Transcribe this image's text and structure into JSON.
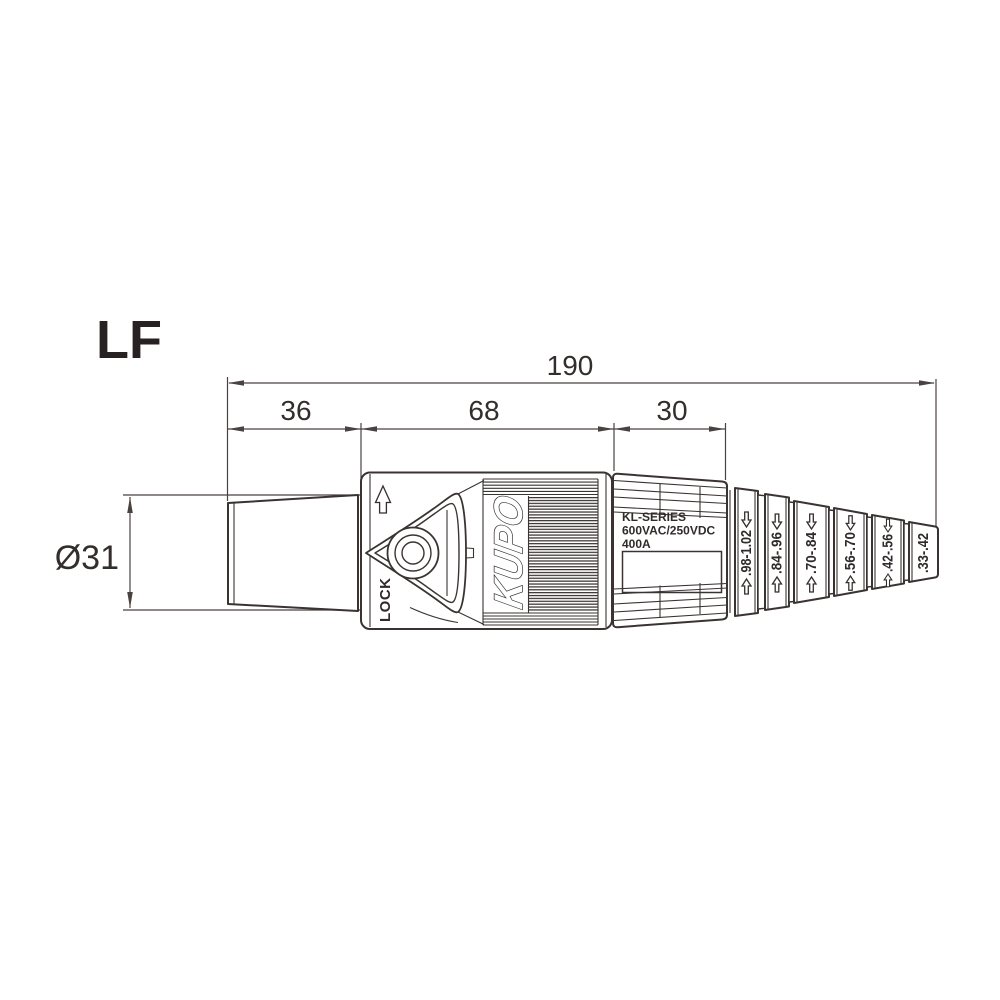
{
  "title": "LF",
  "dimensions": {
    "overall_length": "190",
    "front_length": "36",
    "body_length": "68",
    "rear_length": "30",
    "front_diameter": "Ø31"
  },
  "body": {
    "lock_label": "LOCK",
    "brand_logo": "KUPO"
  },
  "rear_panel": {
    "series": "KL-SERIES",
    "voltage_rating": "600VAC/250VDC",
    "current_rating": "400A"
  },
  "cable_gland": {
    "segments": [
      {
        "range": ".98-1.02"
      },
      {
        "range": ".84-.96"
      },
      {
        "range": ".70-.84"
      },
      {
        "range": ".56-.70"
      },
      {
        "range": ".42-.56"
      },
      {
        "range": ".33-.42"
      }
    ]
  },
  "colors": {
    "line": "#3a3332",
    "dimension_line": "#4a4241",
    "text": "#302b2a",
    "background": "#ffffff"
  }
}
